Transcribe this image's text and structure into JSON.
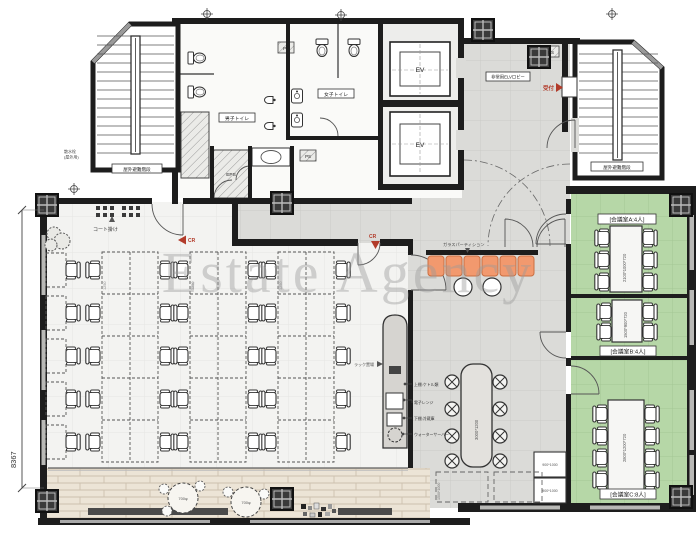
{
  "watermark": {
    "text": "Estate Agency"
  },
  "plan": {
    "stairs": {
      "escape_label": "屋外避難階段",
      "hose_line1": "散水栓",
      "hose_line2": "(屋外用)"
    },
    "toilets": {
      "mens": "男子トイレ",
      "womens": "女子トイレ",
      "ps": "PS",
      "eps": "EPS"
    },
    "elevator": {
      "ev": "EV",
      "lobby": "非常用ELVロビー",
      "reception": "受付"
    },
    "office": {
      "coat_rack": "コート掛け",
      "card_reader": "CR",
      "desk_pitch": "1250"
    },
    "pantry": {
      "glass_partition": "ガラスパーティション",
      "rack": "ラック置場",
      "island_table_dim": "3000*1200",
      "cabinet_dim": "900*1000",
      "equipment_notes": [
        "上棚:ケトル類",
        "電子レンジ",
        "下棚:冷蔵庫",
        "ウォーターサーバー"
      ]
    },
    "meeting_rooms": [
      {
        "label": "[会議室A:4人]",
        "table_dim": "2100*1000*720"
      },
      {
        "label": "[会議室B:4人]",
        "table_dim": "1500*900*720"
      },
      {
        "label": "[会議室C:8人]",
        "table_dim": "2800*1200*720"
      }
    ],
    "terrace": {
      "table_dim": "700φ",
      "overhang_dim": "1500*1000"
    },
    "dimensions": {
      "overall_height": "8367"
    },
    "colors": {
      "accent_red": "#b23b2a",
      "meeting_green": "#b6d7a7",
      "bench_orange": "#f2996e",
      "floor_gray": "#dbdbd8",
      "wood": "#ece4d6"
    }
  }
}
